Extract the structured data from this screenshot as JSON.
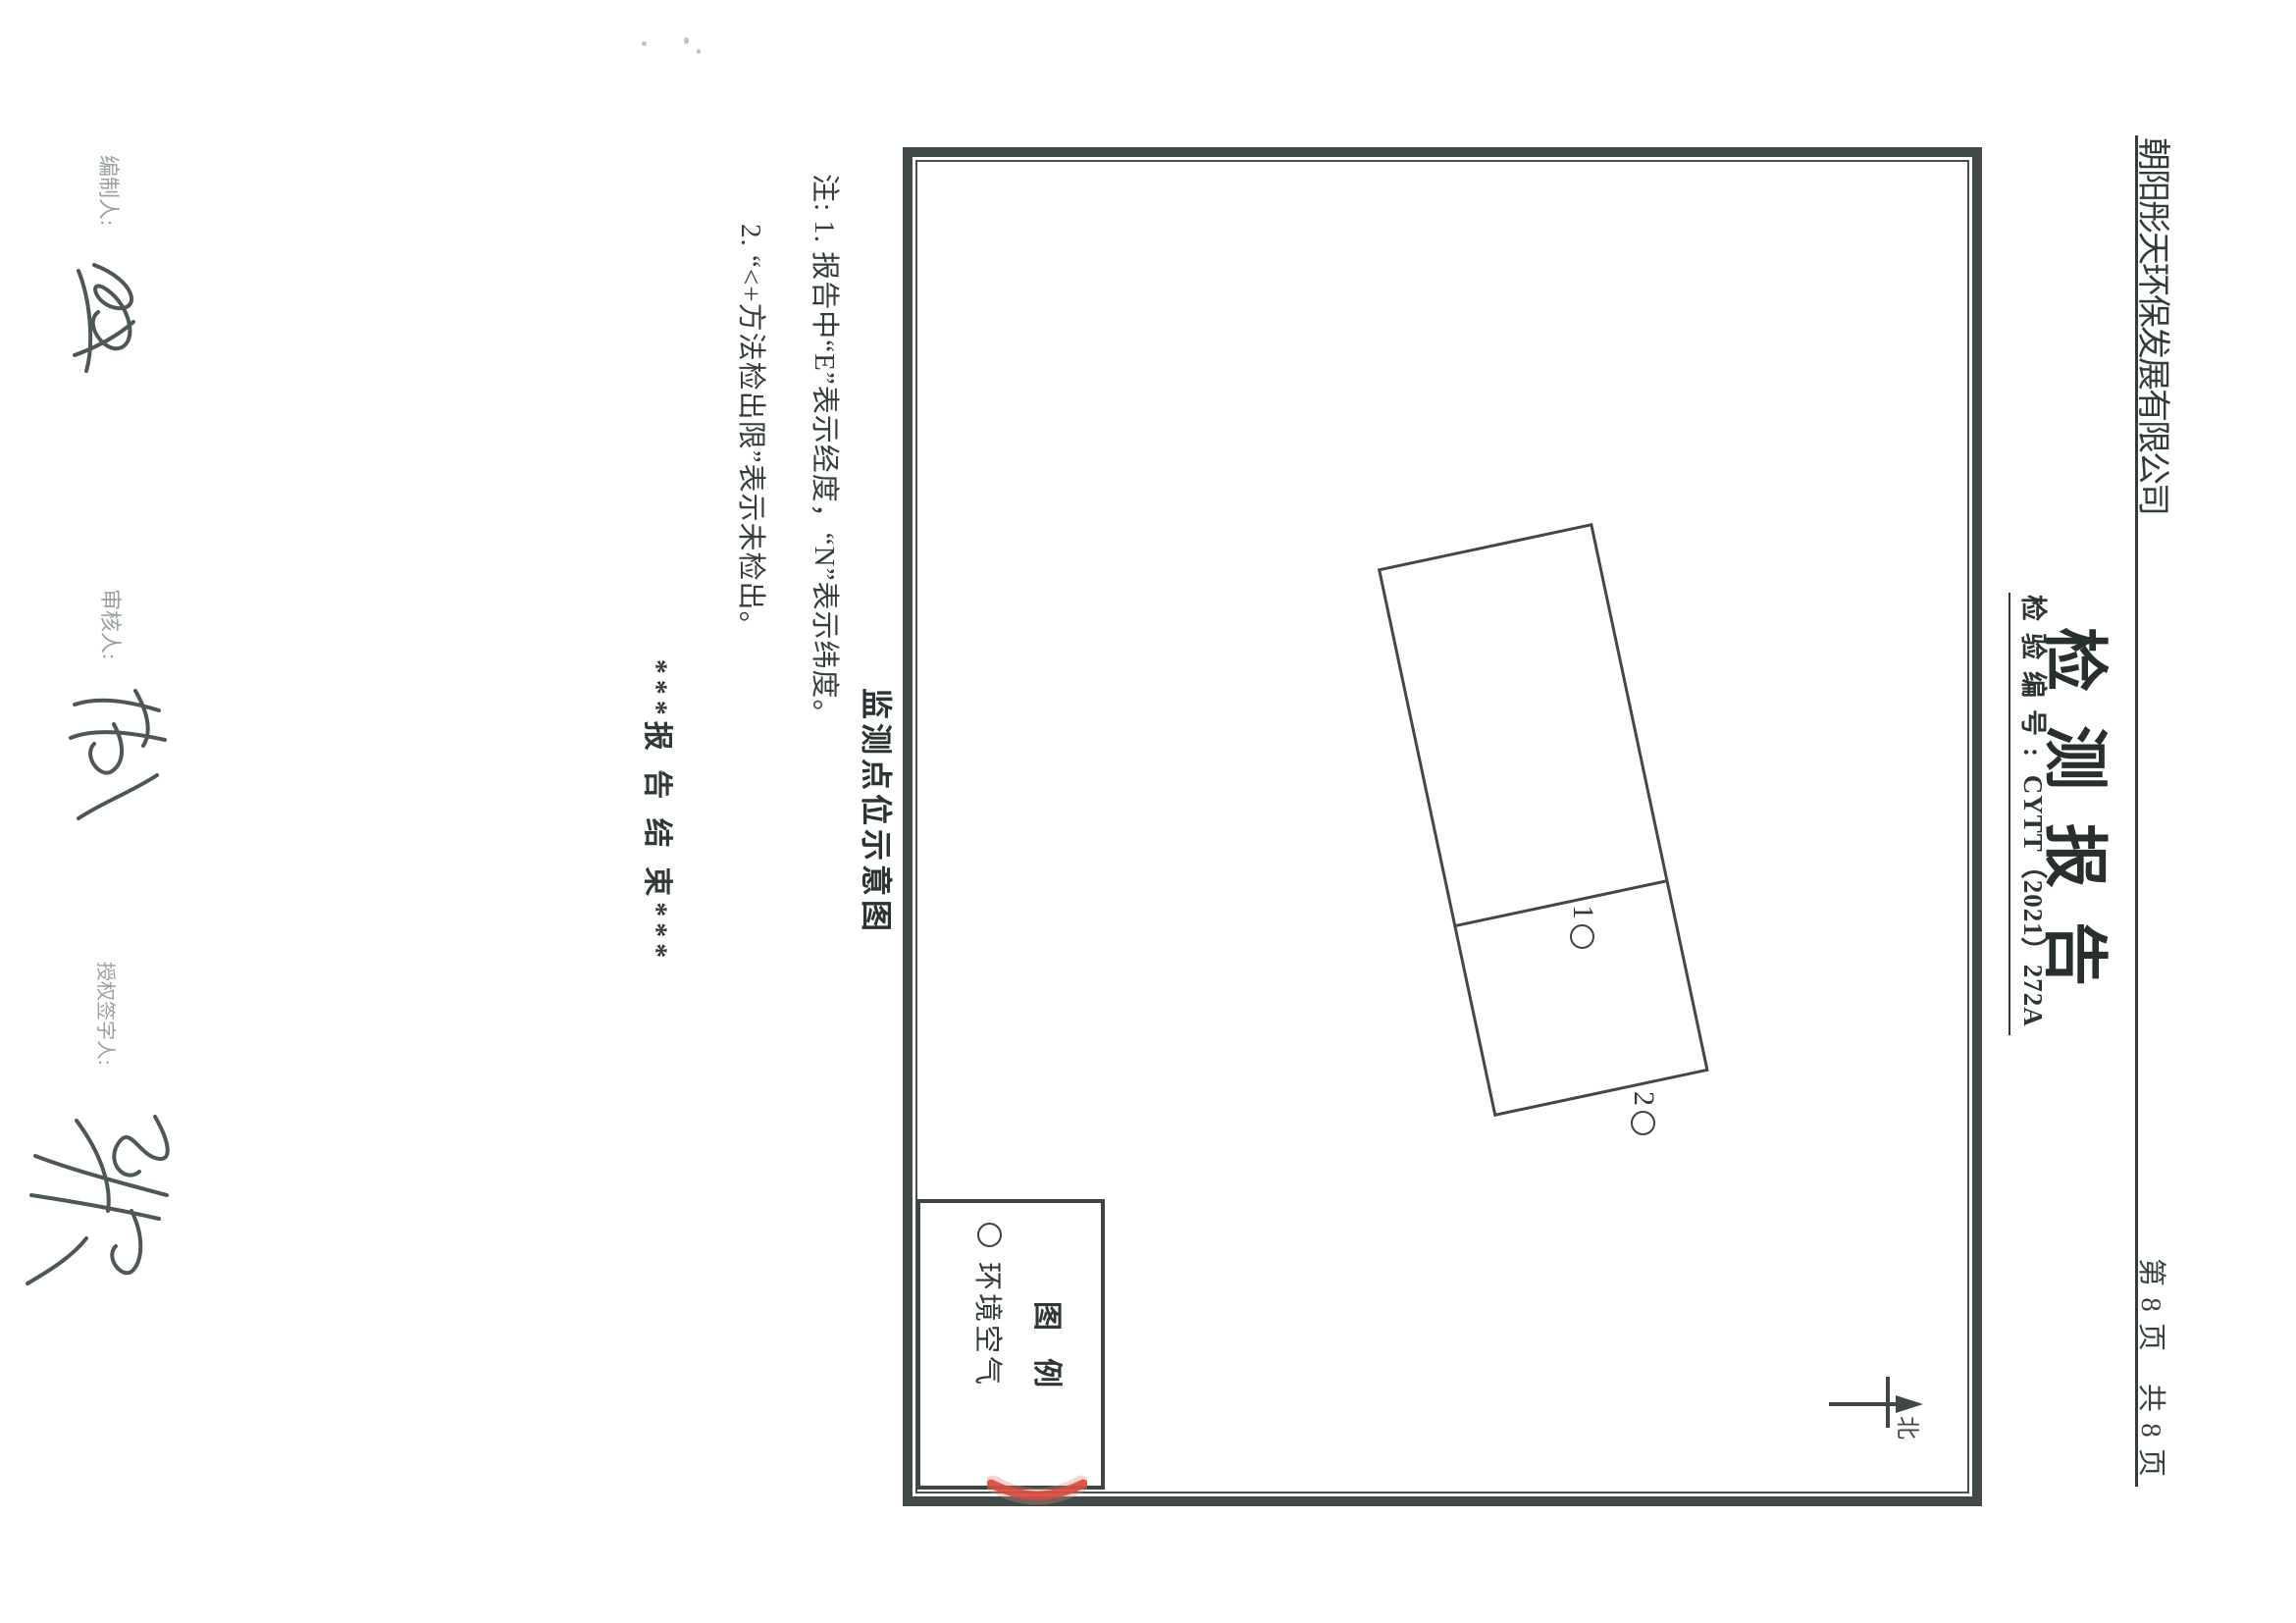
{
  "header": {
    "company": "朝阳彤天环保发展有限公司",
    "page_info": "第 8 页　共 8 页"
  },
  "title_block": {
    "title": "检测报告",
    "report_no_label": "检验编号:",
    "report_no_value": "CYTT（2021）272A"
  },
  "diagram": {
    "caption": "监测点位示意图",
    "points": [
      {
        "num": "1",
        "marker": "circle"
      },
      {
        "num": "2",
        "marker": "circle"
      }
    ],
    "north_label": "北",
    "legend": {
      "title": "图例",
      "item_label": "环境空气"
    }
  },
  "notes": {
    "line1": "注: 1. 报告中“E”表示经度，“N”表示纬度。",
    "line2": "2. “<+方法检出限”表示未检出。"
  },
  "end_mark": "***报 告 结 束***",
  "signatures": [
    {
      "label": "编制人:"
    },
    {
      "label": "审核人:"
    },
    {
      "label": "授权签字人:"
    }
  ],
  "colors": {
    "ink": "#323b3b",
    "border": "#414a48",
    "stamp_red": "#d84b3d"
  }
}
